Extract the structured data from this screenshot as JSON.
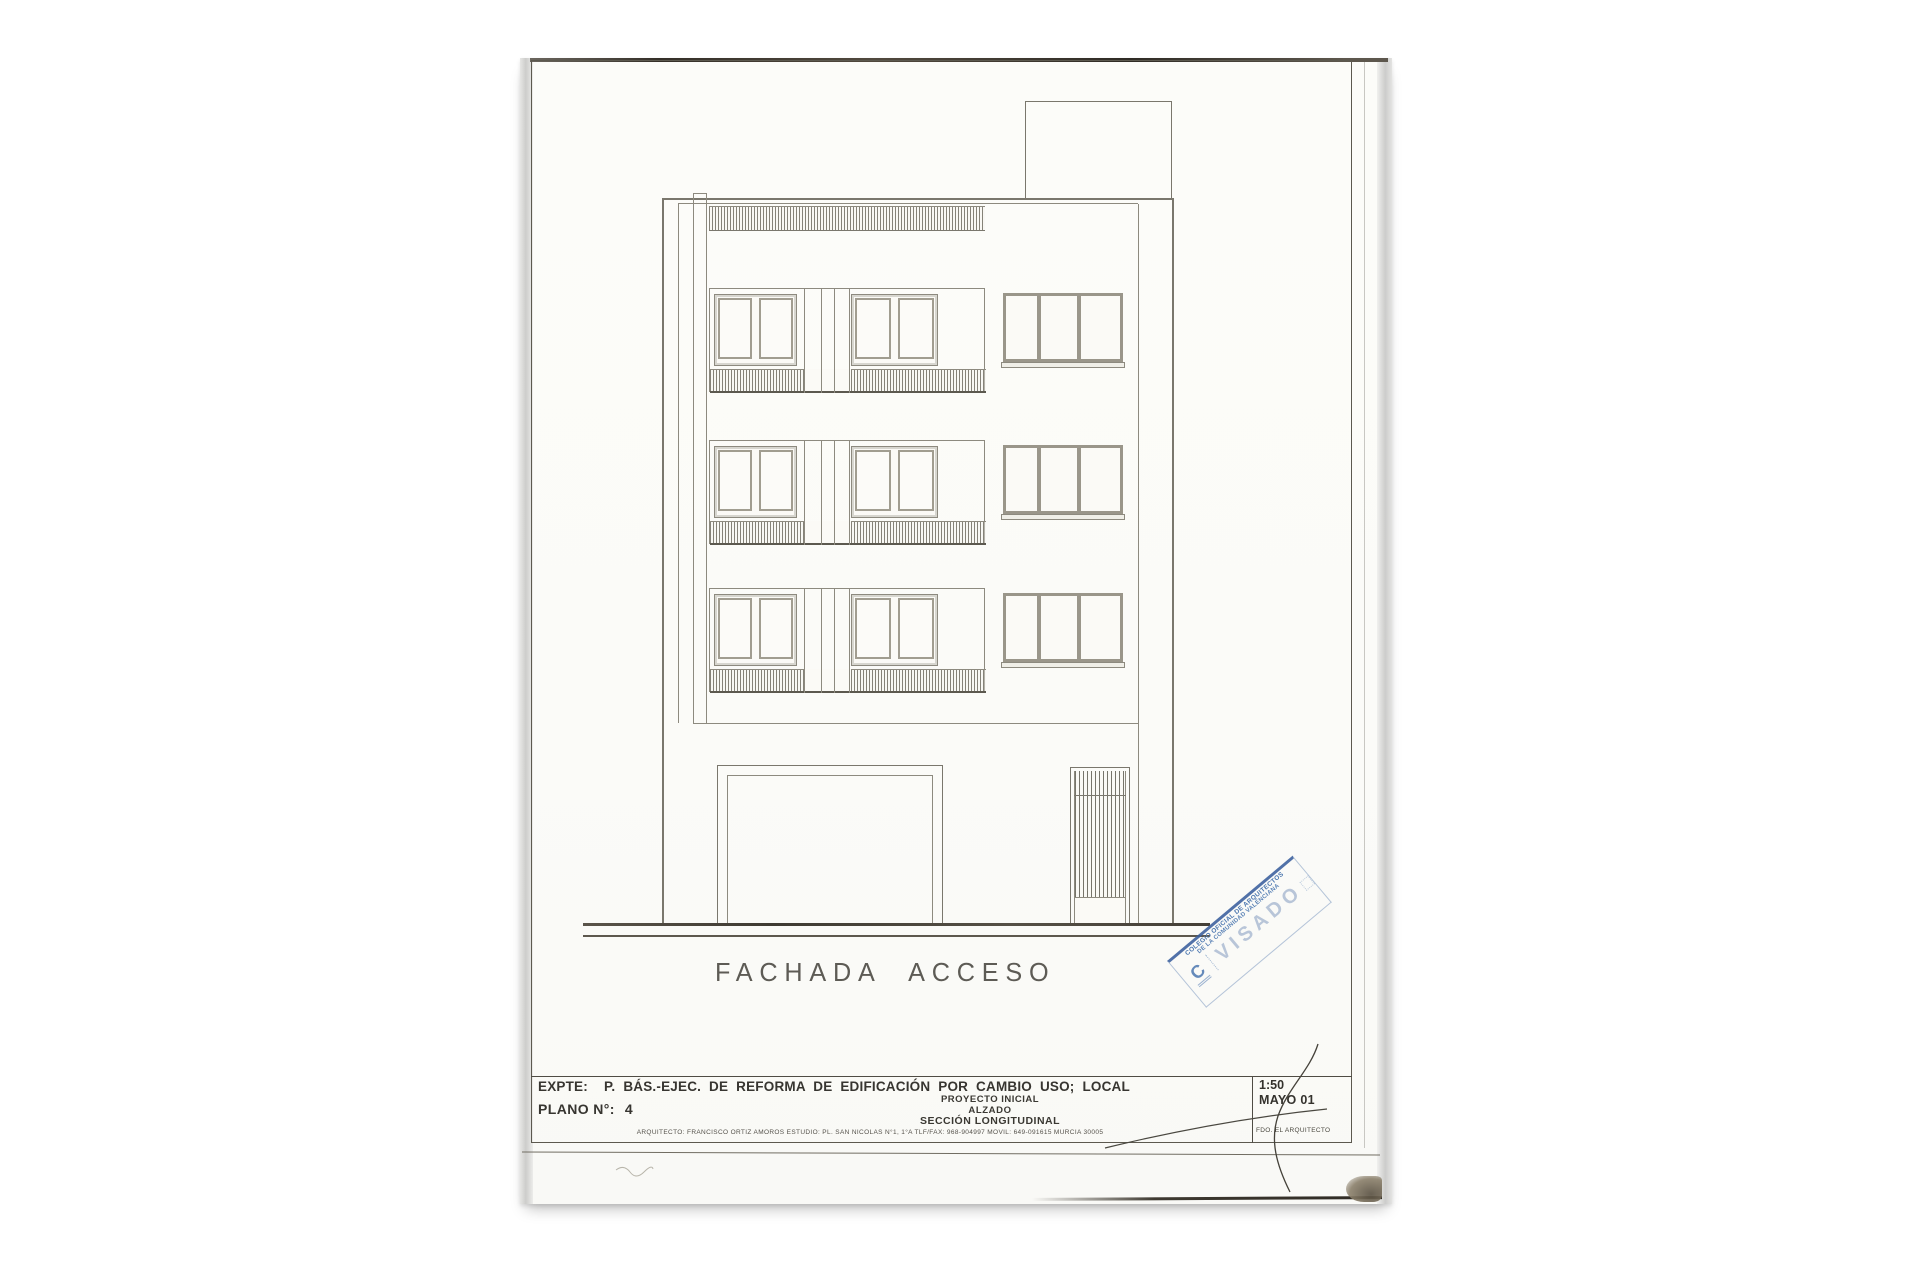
{
  "document": {
    "drawing_title": "FACHADA ACCESO"
  },
  "title_block": {
    "expte_label": "EXPTE:",
    "expte_value": "P. BÁS.-EJEC. DE REFORMA DE EDIFICACIÓN POR CAMBIO USO; LOCAL",
    "plano_label": "PLANO N°:",
    "plano_number": "4",
    "project_phase": "PROYECTO INICIAL",
    "drawing_type": "ALZADO",
    "drawing_subtype": "SECCIÓN LONGITUDINAL",
    "architect_info": "ARQUITECTO: FRANCISCO ORTIZ AMOROS   ESTUDIO: PL. SAN NICOLAS N°1, 1°A   TLF/FAX: 968-904997   MOVIL: 649-091615   MURCIA   30005",
    "scale": "1:50",
    "date": "MAYO 01",
    "signature_caption": "FDO. EL ARQUITECTO"
  },
  "stamp": {
    "org_line1": "COLEGIO OFICIAL DE ARQUITECTOS",
    "org_line2": "DE LA COMUNIDAD VALENCIANA",
    "status": "VISADO",
    "logo_letter": "C",
    "color_primary": "#4a74ad",
    "color_faint": "#9db3d2"
  }
}
